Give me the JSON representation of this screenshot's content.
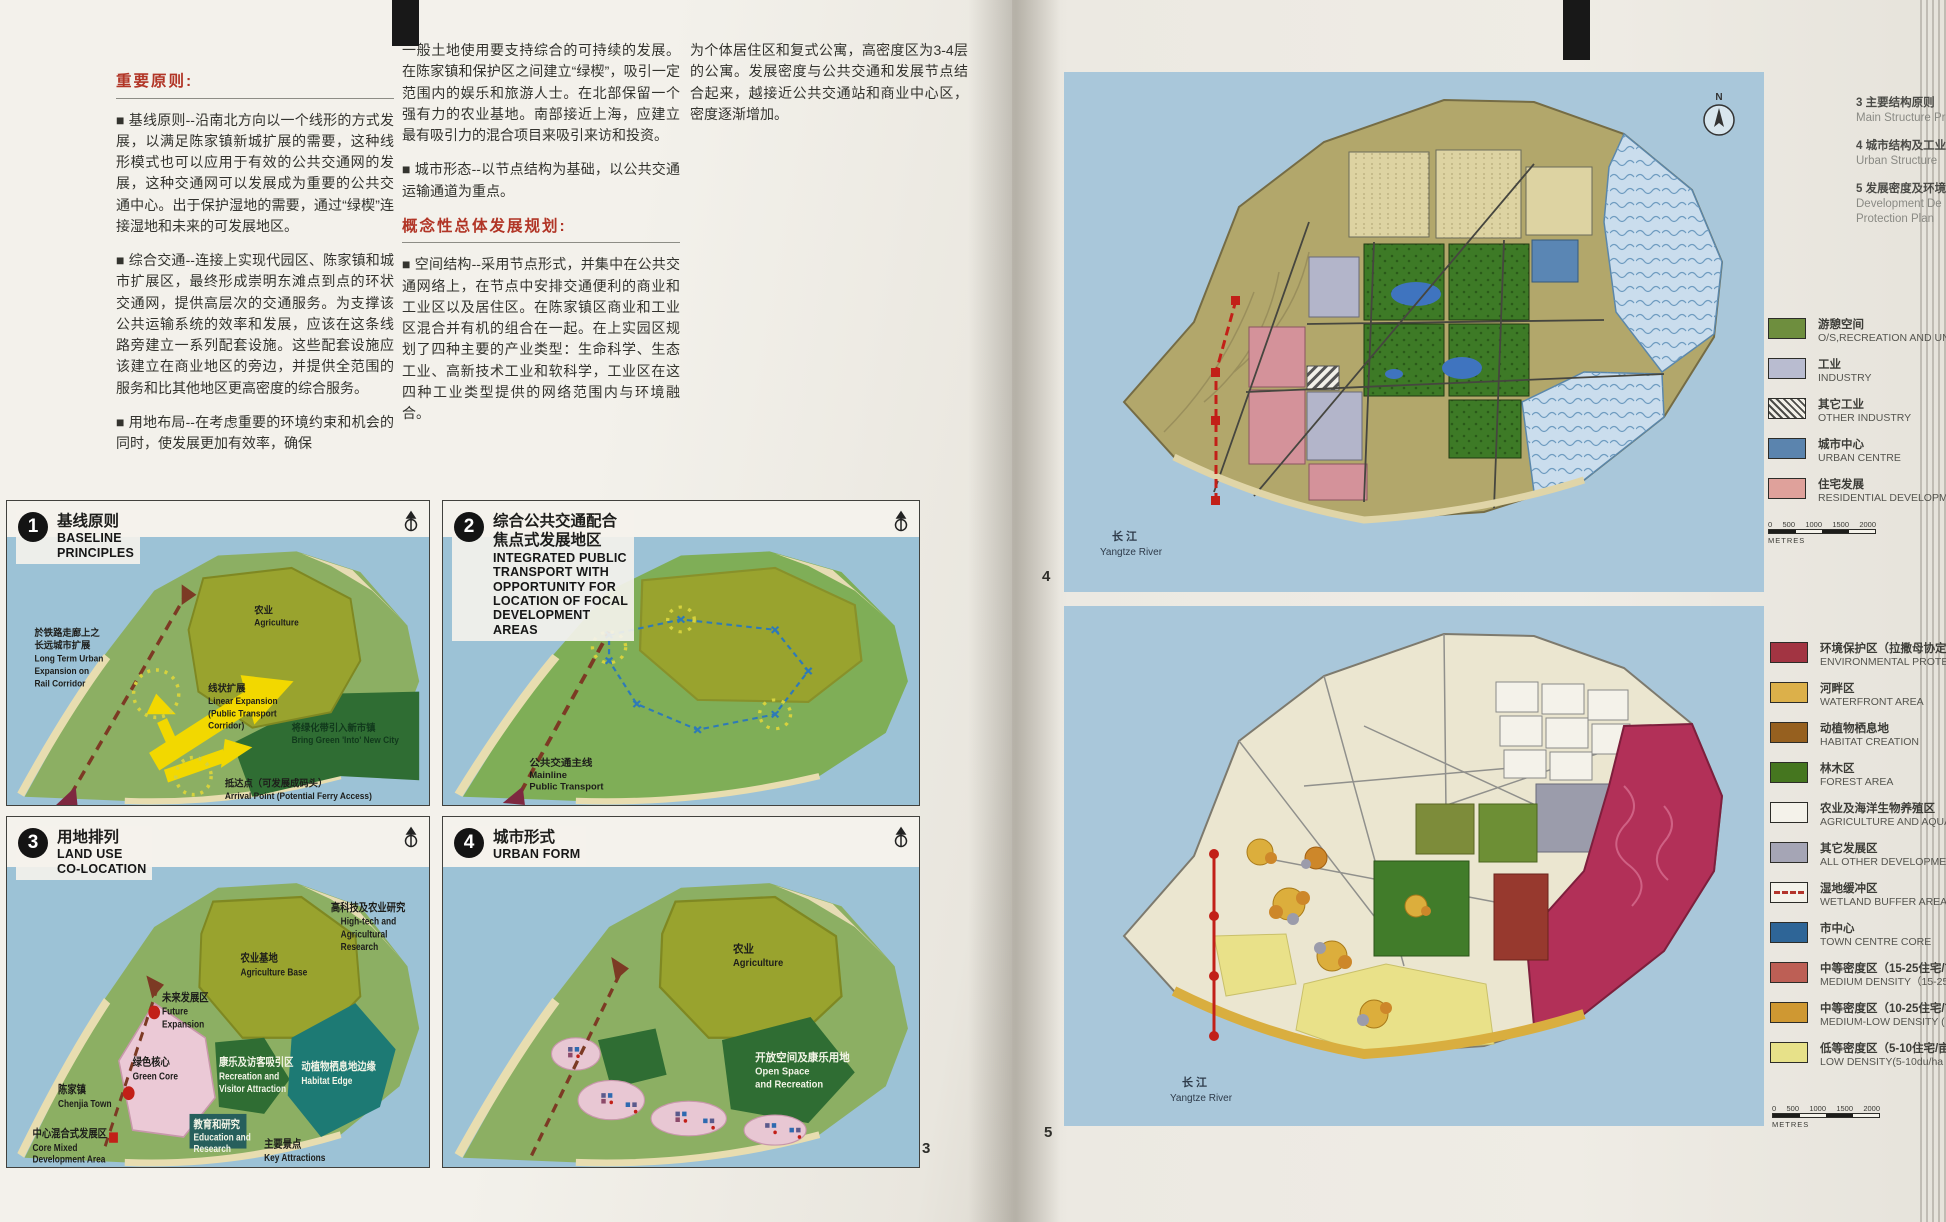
{
  "left_page": {
    "page_number": "3",
    "text": {
      "heading1": "重要原则:",
      "c1p1": "■ 基线原则--沿南北方向以一个线形的方式发展，以满足陈家镇新城扩展的需要，这种线形模式也可以应用于有效的公共交通网的发展，这种交通网可以发展成为重要的公共交通中心。出于保护湿地的需要，通过“绿楔”连接湿地和未来的可发展地区。",
      "c1p2": "■ 综合交通--连接上实现代园区、陈家镇和城市扩展区，最终形成崇明东滩点到点的环状交通网，提供高层次的交通服务。为支撑该公共运输系统的效率和发展，应该在这条线路旁建立一系列配套设施。这些配套设施应该建立在商业地区的旁边，并提供全范围的服务和比其他地区更高密度的综合服务。",
      "c1p3": "■ 用地布局--在考虑重要的环境约束和机会的同时，使发展更加有效率，确保",
      "c2p1": "一般土地使用要支持综合的可持续的发展。在陈家镇和保护区之间建立“绿楔”，吸引一定范围内的娱乐和旅游人士。在北部保留一个强有力的农业基地。南部接近上海，应建立最有吸引力的混合项目来吸引来访和投资。",
      "c2p2": "■ 城市形态--以节点结构为基础，以公共交通运输通道为重点。",
      "heading2": "概念性总体发展规划:",
      "c2p3": "■ 空间结构--采用节点形式，并集中在公共交通网络上，在节点中安排交通便利的商业和工业区以及居住区。在陈家镇区商业和工业区混合并有机的组合在一起。在上实园区规划了四种主要的产业类型：生命科学、生态工业、高新技术工业和软科学，工业区在这四种工业类型提供的网络范围内与环境融合。",
      "c3p1": "为个体居住区和复式公寓，高密度区为3-4层的公寓。发展密度与公共交通和发展节点结合起来，越接近公共交通站和商业中心区，密度逐渐增加。"
    },
    "panels": [
      {
        "num": "1",
        "zh": "基线原则",
        "en_lines": [
          "BASELINE",
          "PRINCIPLES"
        ],
        "labels": {
          "agri_zh": "农业",
          "agri_en": "Agriculture",
          "lt1": "於铁路走廊上之",
          "lt2": "长远城市扩展",
          "lt3": "Long Term Urban",
          "lt4": "Expansion on",
          "lt5": "Rail Corridor",
          "bg1": "将绿化带引入新市镇",
          "bg2": "Bring Green 'Into' New City",
          "le1": "线状扩展",
          "le2": "Linear Expansion",
          "le3": "(Public Transport",
          "le4": "Corridor)",
          "ap1": "抵达点（可发展成码头）",
          "ap2": "Arrival Point (Potential Ferry Access)"
        }
      },
      {
        "num": "2",
        "zh": "综合公共交通配合",
        "zh2": "焦点式发展地区",
        "en_lines": [
          "INTEGRATED PUBLIC",
          "TRANSPORT WITH",
          "OPPORTUNITY FOR",
          "LOCATION OF FOCAL",
          "DEVELOPMENT",
          "AREAS"
        ],
        "labels": {
          "ml1": "公共交通主线",
          "ml2": "Mainline",
          "ml3": "Public Transport"
        }
      },
      {
        "num": "3",
        "zh": "用地排列",
        "en_lines": [
          "LAND USE",
          "CO-LOCATION"
        ],
        "labels": {
          "ab1": "农业基地",
          "ab2": "Agriculture Base",
          "ht1": "高科技及农业研究",
          "ht2": "High-tech and",
          "ht3": "Agricultural",
          "ht4": "Research",
          "fe1": "未来发展区",
          "fe2": "Future",
          "fe3": "Expansion",
          "rv1": "康乐及访客吸引区",
          "rv2": "Recreation and",
          "rv3": "Visitor Attraction",
          "he1": "动植物栖息地边缘",
          "he2": "Habitat Edge",
          "ct1": "陈家镇",
          "ct2": "Chenjia Town",
          "gc1": "绿色核心",
          "gc2": "Green Core",
          "cm1": "中心混合式发展区",
          "cm2": "Core Mixed",
          "cm3": "Development Area",
          "er1": "教育和研究",
          "er2": "Education and",
          "er3": "Research",
          "ka1": "主要景点",
          "ka2": "Key Attractions"
        }
      },
      {
        "num": "4",
        "zh": "城市形式",
        "en_lines": [
          "URBAN FORM"
        ],
        "labels": {
          "ag1": "农业",
          "ag2": "Agriculture",
          "os1": "开放空间及康乐用地",
          "os2": "Open Space",
          "os3": "and Recreation"
        }
      }
    ]
  },
  "right_page": {
    "notes": [
      {
        "n": "3",
        "zh": "主要结构原则",
        "en1": "Main Structure Pr",
        "en2": ""
      },
      {
        "n": "4",
        "zh": "城市结构及工业",
        "en1": "Urban Structure",
        "en2": ""
      },
      {
        "n": "5",
        "zh": "发展密度及环境",
        "en1": "Development De",
        "en2": "Protection Plan"
      }
    ],
    "map1": {
      "fig": "4",
      "river_zh": "长 江",
      "river_en": "Yangtze River",
      "north": "N"
    },
    "map2": {
      "fig": "5",
      "river_zh": "长 江",
      "river_en": "Yangtze River"
    },
    "legend_top": [
      {
        "zh": "游憩空间",
        "en": "O/S,RECREATION AND UNDEV",
        "color": "#6e8e3e"
      },
      {
        "zh": "工业",
        "en": "INDUSTRY",
        "color": "#b9bcd0"
      },
      {
        "zh": "其它工业",
        "en": "OTHER INDUSTRY",
        "color": "hatch"
      },
      {
        "zh": "城市中心",
        "en": "URBAN CENTRE",
        "color": "#5b84ae"
      },
      {
        "zh": "住宅发展",
        "en": "RESIDENTIAL DEVELOPMENT",
        "color": "#dfa19b"
      }
    ],
    "legend_bottom": [
      {
        "zh": "环境保护区（拉撒母协定湿地",
        "en": "ENVIRONMENTAL PROTECT",
        "color": "#a23442"
      },
      {
        "zh": "河畔区",
        "en": "WATERFRONT AREA",
        "color": "#dcb04a"
      },
      {
        "zh": "动植物栖息地",
        "en": "HABITAT CREATION",
        "color": "#96601f"
      },
      {
        "zh": "林木区",
        "en": "FOREST AREA",
        "color": "#45761f"
      },
      {
        "zh": "农业及海洋生物养殖区",
        "en": "AGRICULTURE AND AQUA",
        "color": "#f4f2ea"
      },
      {
        "zh": "其它发展区",
        "en": "ALL OTHER DEVELOPMEN",
        "color": "#a5a5b5"
      },
      {
        "zh": "湿地缓冲区",
        "en": "WETLAND BUFFER AREA (",
        "color": "wetland"
      },
      {
        "zh": "市中心",
        "en": "TOWN CENTRE CORE",
        "color": "#2e6597"
      },
      {
        "zh": "中等密度区（15-25住宅/亩",
        "en": "MEDIUM DENSITY（15-25",
        "color": "#bd5f55"
      },
      {
        "zh": "中等密度区（10-25住宅/亩",
        "en": "MEDIUM-LOW DENSITY (",
        "color": "#cf9832"
      },
      {
        "zh": "低等密度区（5-10住宅/亩",
        "en": "LOW DENSITY(5-10du/ha",
        "color": "#e7e189"
      }
    ],
    "scalebar1": {
      "t0": "0",
      "t1": "500",
      "t2": "1000",
      "t3": "1500",
      "t4": "2000",
      "unit": "METRES"
    },
    "scalebar2": {
      "t0": "0",
      "t1": "500",
      "t2": "1000",
      "t3": "1500",
      "t4": "2000",
      "unit": "METRES"
    }
  }
}
